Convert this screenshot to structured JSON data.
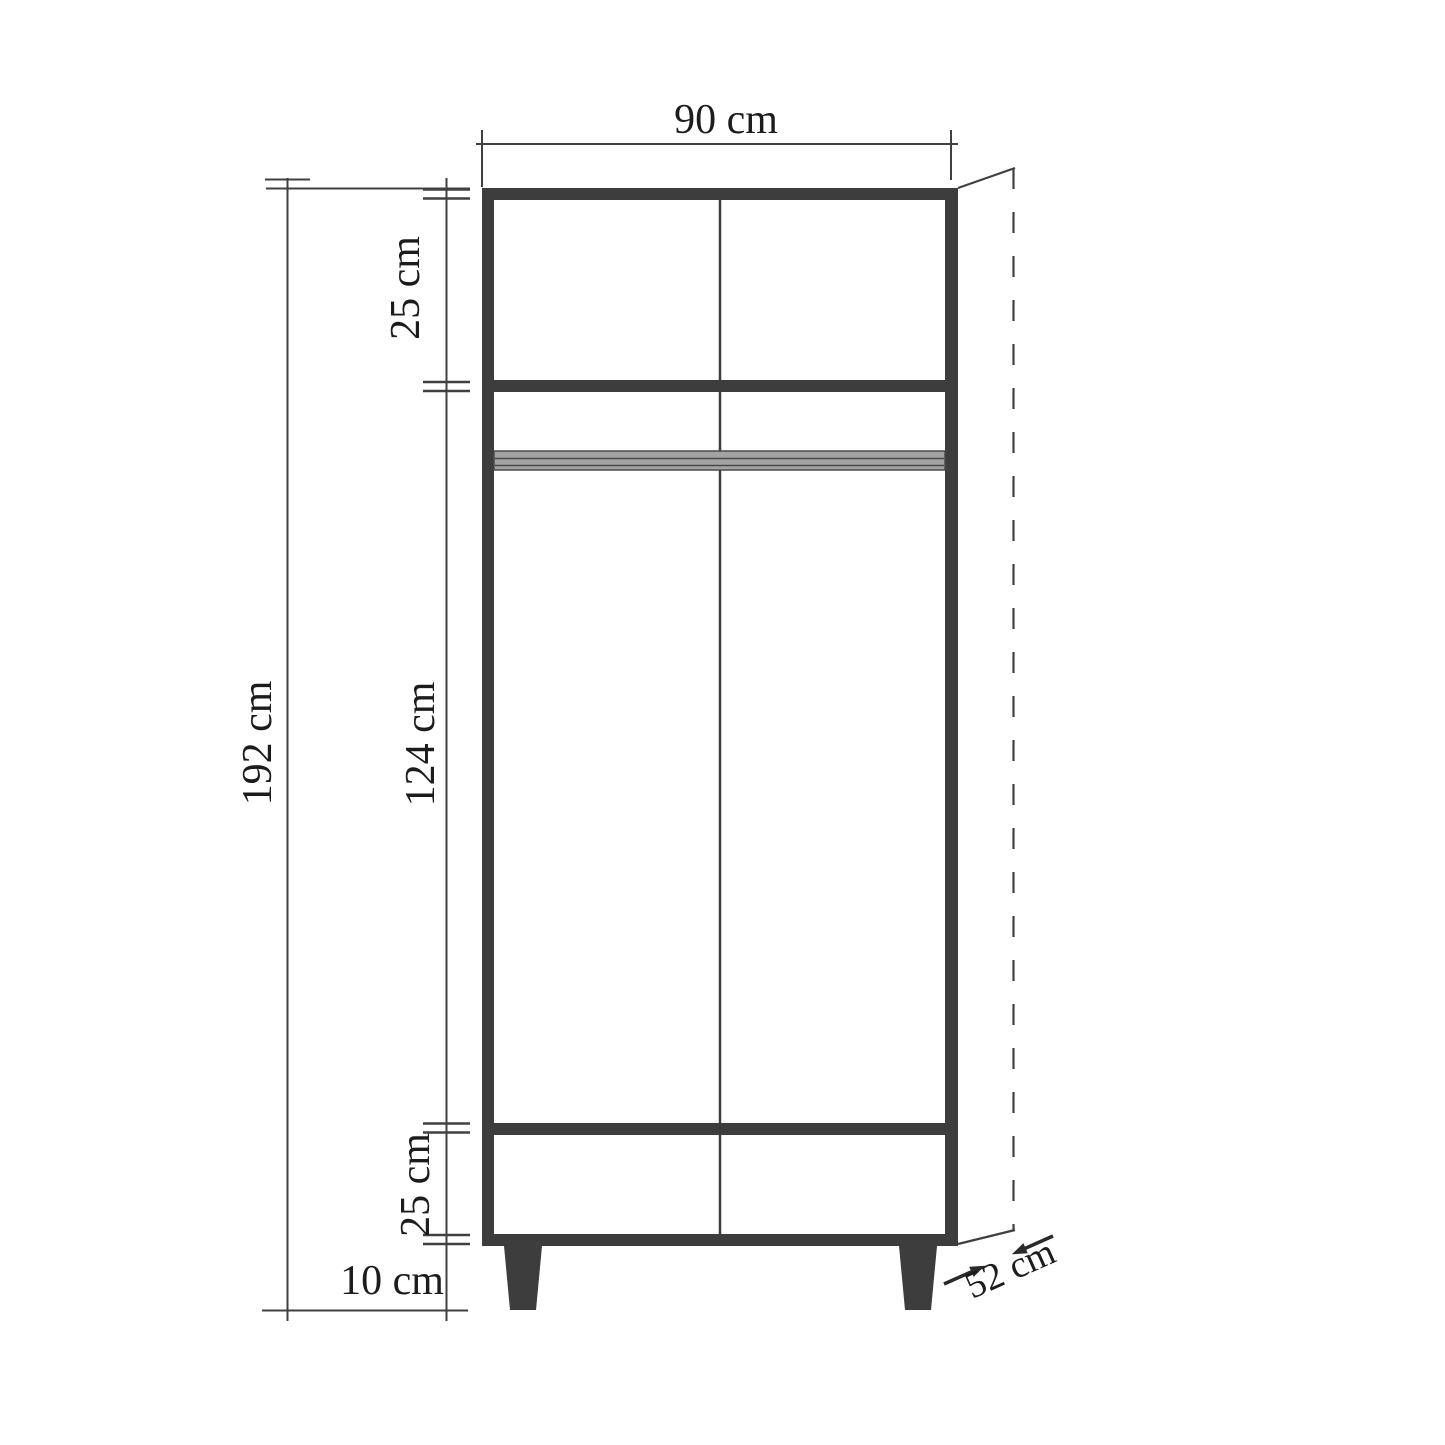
{
  "diagram": {
    "title": "wardrobe-dimension-drawing",
    "labels": {
      "width": "90 cm",
      "total_height": "192 cm",
      "top_section_height": "25 cm",
      "middle_section_height": "124 cm",
      "bottom_section_height": "25 cm",
      "leg_height": "10 cm",
      "depth": "52 cm"
    },
    "dimensions_cm": {
      "width": 90,
      "total_height": 192,
      "top_section": 25,
      "middle_section": 124,
      "bottom_section": 25,
      "legs": 10,
      "depth": 52
    },
    "colors": {
      "background": "#ffffff",
      "frame": "#3d3d3d",
      "thin_line": "#404040",
      "rod_fill": "#a3a3a3",
      "rod_line": "#4a4a4a",
      "text": "#1c1c1c",
      "arrow": "#2a2a2a"
    }
  }
}
